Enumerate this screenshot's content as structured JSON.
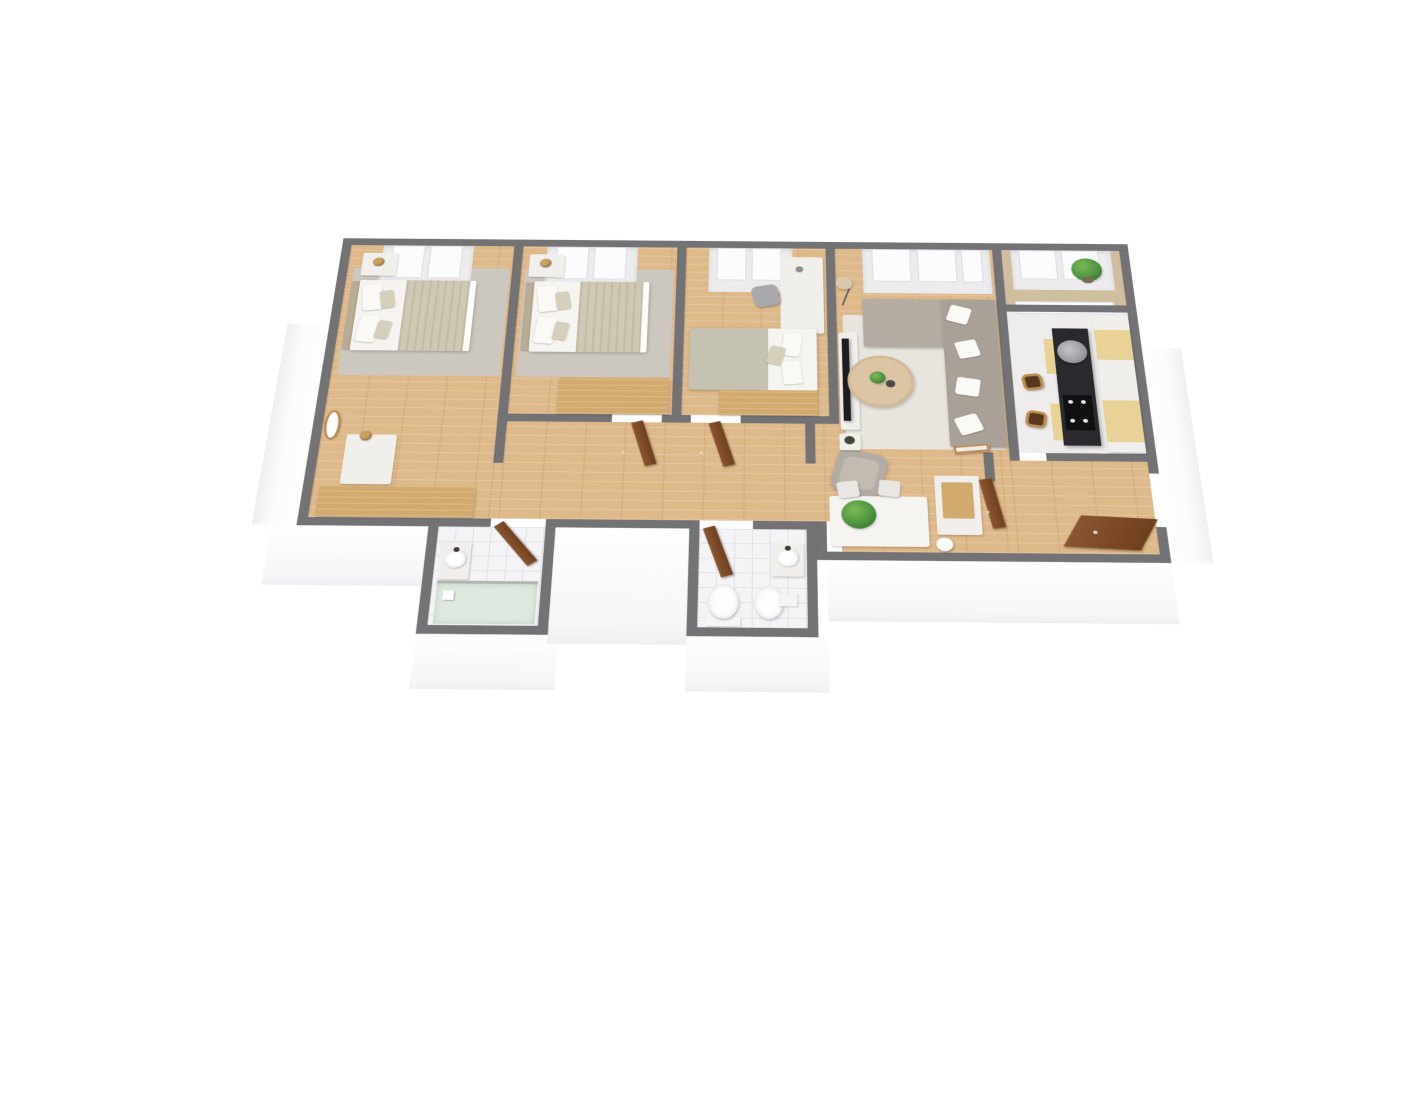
{
  "view": {
    "type": "3d-floor-plan-render",
    "style": "isometric-top-down",
    "background": "#ffffff"
  },
  "palette": {
    "bg": "#ffffff",
    "wall": "#737376",
    "floor-wood": "#deb98a",
    "floor-kitchen": "#efedeb",
    "floor-balcony": "#cfbf9f",
    "tile": "#f4f4f6",
    "tile-line": "#dfdfe4",
    "rug-bedroom": "#cdc8bf",
    "rug-living": "#e8e5df",
    "bed-duvet": "#f5f4f0",
    "bed-blanket": "#cfc8b3",
    "headboard": "#b9ac97",
    "pillow": "#faf9f6",
    "pillow-accent": "#d6cfbc",
    "white-furniture": "#f1efeb",
    "wood-furniture": "#d3aa6e",
    "door": "#8a5530",
    "door-dark": "#6f3f1e",
    "sofa": "#a9a198",
    "sofa-light": "#b5ada4",
    "armchair": "#b3aca4",
    "coffee-table": "#dcc5a5",
    "tv": "#1d1d21",
    "island": "#2a2a2e",
    "hood": "#9b9ba1",
    "cooktop": "#101012",
    "counter-accent": "#e9d295",
    "stool-wood": "#bd8d50",
    "plant": "#4e9440",
    "plant-dark": "#2f6b2c",
    "lamp-gold": "#c9a25e",
    "glass-shower": "#dfe9e0",
    "chrome": "#aeb6af",
    "mirror-frame": "#c08a52",
    "fixture-metal": "#3c3c40"
  },
  "scene": {
    "rooms": [
      {
        "id": "bedroom-1",
        "floor": "wood",
        "furniture": [
          "double-bed",
          "headboard",
          "pillows",
          "ribbed-blanket",
          "nightstand",
          "gold-table-lamp",
          "area-rug",
          "oval-wall-mirror",
          "dresser",
          "gold-table-lamp",
          "wooden-bench"
        ],
        "window": true
      },
      {
        "id": "bedroom-2",
        "floor": "wood",
        "furniture": [
          "double-bed",
          "headboard",
          "pillows",
          "ribbed-blanket",
          "nightstand",
          "gold-table-lamp",
          "area-rug",
          "wooden-chest"
        ],
        "window": true
      },
      {
        "id": "bedroom-3",
        "floor": "wood",
        "furniture": [
          "double-bed",
          "sage-duvet",
          "pillows",
          "desk",
          "office-chair",
          "desk-lamp",
          "wooden-chest"
        ],
        "window": true
      },
      {
        "id": "living-room",
        "floor": "wood",
        "furniture": [
          "corner-sofa",
          "throw-pillows",
          "round-coffee-table",
          "potted-plants",
          "area-rug",
          "tv",
          "tv-stand",
          "floor-lamp",
          "armchair",
          "side-table"
        ],
        "window": true
      },
      {
        "id": "dining-area",
        "floor": "wood",
        "furniture": [
          "dining-table",
          "dining-chairs",
          "fern-plant",
          "sideboard",
          "table-lamp",
          "leaning-mirror"
        ]
      },
      {
        "id": "kitchen",
        "floor": "light",
        "furniture": [
          "dark-counter-island",
          "round-range-hood",
          "cooktop",
          "tall-cabinet-row",
          "accent-cabinets",
          "bar-stools"
        ],
        "window": true
      },
      {
        "id": "balcony",
        "floor": "balcony",
        "furniture": [
          "potted-plant"
        ],
        "window": true
      },
      {
        "id": "hallway",
        "floor": "wood",
        "furniture": [
          "bedroom-2-door",
          "bedroom-3-door"
        ]
      },
      {
        "id": "bathroom-1",
        "floor": "tile",
        "furniture": [
          "door",
          "washbasin",
          "faucet",
          "shower",
          "glass-screen"
        ]
      },
      {
        "id": "bathroom-2",
        "floor": "tile",
        "furniture": [
          "door",
          "washbasin",
          "faucet",
          "toilet",
          "bidet"
        ]
      },
      {
        "id": "entry",
        "floor": "wood",
        "furniture": [
          "front-door",
          "kitchen-door",
          "hall-cabinet"
        ]
      }
    ],
    "doors_color": "brown",
    "walls_color": "gray",
    "text_labels": []
  }
}
